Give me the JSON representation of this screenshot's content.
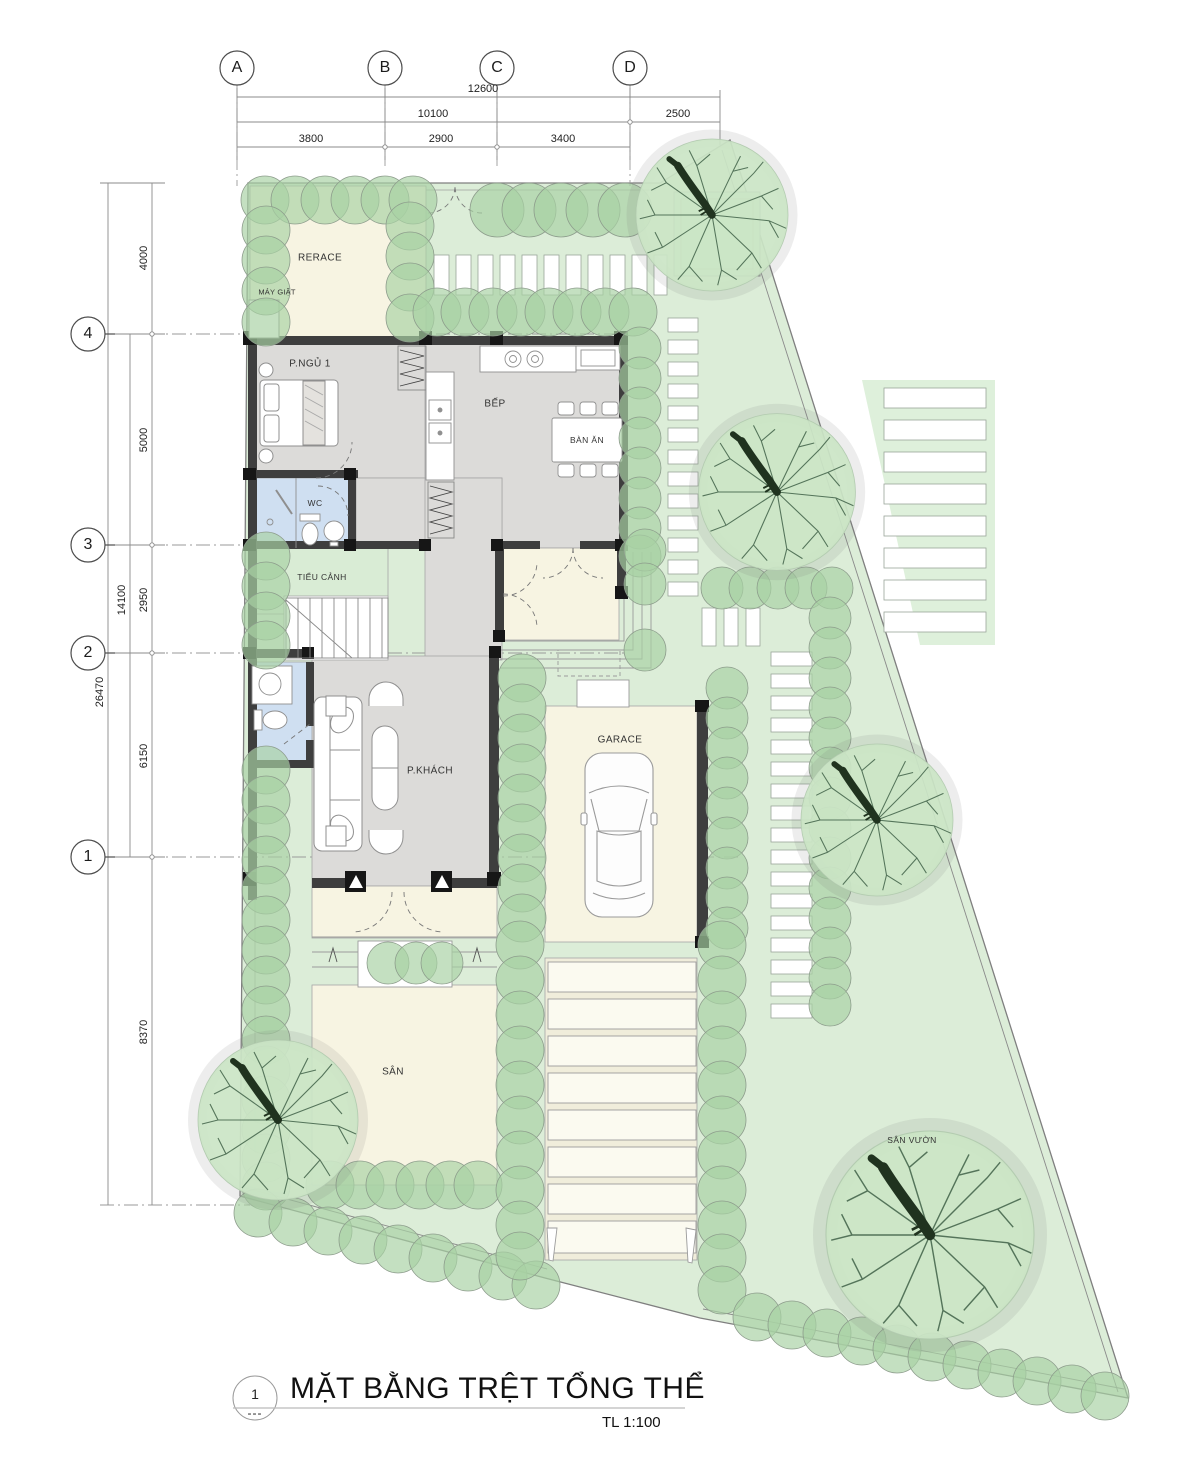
{
  "drawing": {
    "title": "MẶT BẰNG TRỆT TỔNG THỂ",
    "scale": "TL 1:100",
    "sheet_number": "1",
    "sheet_dashes": "---"
  },
  "grid": {
    "columns": [
      {
        "label": "A"
      },
      {
        "label": "B"
      },
      {
        "label": "C"
      },
      {
        "label": "D"
      }
    ],
    "rows": [
      {
        "label": "4"
      },
      {
        "label": "3"
      },
      {
        "label": "2"
      },
      {
        "label": "1"
      }
    ]
  },
  "dimensions": {
    "top": {
      "total": "12600",
      "left_span": "10100",
      "right_span": "2500",
      "seg_ab": "3800",
      "seg_bc": "2900",
      "seg_cd": "3400"
    },
    "left": {
      "outer_total": "26470",
      "mid_total": "14100",
      "seg_top_4": "4000",
      "seg_4_3": "5000",
      "seg_3_2": "2950",
      "seg_2_1": "6150",
      "seg_1_bottom": "8370"
    }
  },
  "rooms": {
    "terrace": "RERACE",
    "washer": "MÁY GIẶT",
    "bedroom1": "P.NGỦ 1",
    "kitchen": "BẾP",
    "dining_table": "BÀN ĂN",
    "wc": "WC",
    "tieu_canh": "TIỂU CẢNH",
    "living": "P.KHÁCH",
    "garage": "GARACE",
    "yard": "SÂN",
    "garden": "SÂN VƯỜN"
  },
  "colors": {
    "site_green": "#dcedd8",
    "shrub_green": "#a8d1a4",
    "tree_foliage": "#cbe5c6",
    "floor_gray": "#dcdbd9",
    "floor_cream": "#f7f4e2",
    "wc_blue": "#cfdff1",
    "tieu_canh_green": "#d9ecd5",
    "wall_dark": "#3e3e3e"
  }
}
